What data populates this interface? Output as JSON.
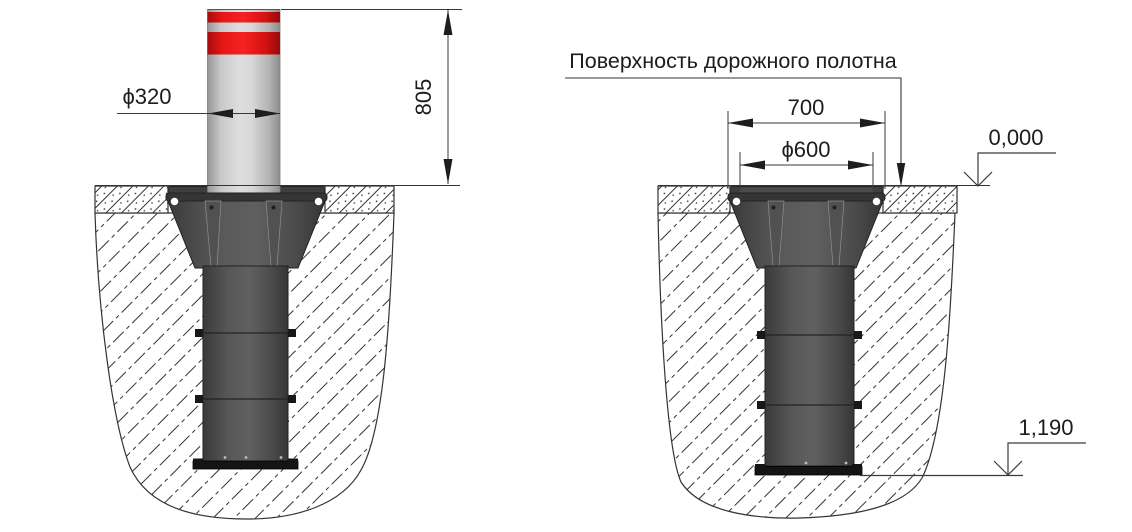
{
  "drawing": {
    "title_label": "Поверхность дорожного полотна",
    "left_view": {
      "name": "bollard-extended-elevation",
      "dimensions": {
        "diameter": "ϕ320",
        "height": "805"
      }
    },
    "right_view": {
      "name": "bollard-retracted-installation-section",
      "dimensions": {
        "flange_width": "700",
        "casing_diameter": "ϕ600"
      },
      "levels": {
        "surface": "0,000",
        "depth": "1,190"
      }
    },
    "colors": {
      "stripe_red": "#e21414",
      "bollard_gray": "#d6d6d6",
      "casing_dark": "#4a4a4a",
      "base_plate": "#141414",
      "line": "#333333",
      "background": "#ffffff"
    }
  }
}
